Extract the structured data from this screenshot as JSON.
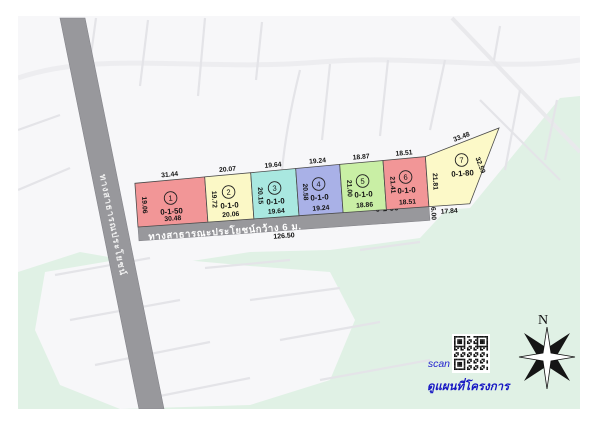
{
  "map": {
    "background_color": "#f7f7f9",
    "field_color": "#e0f1e5",
    "street_color": "#e4e4e8",
    "road_color": "#98989c",
    "plot_border_color": "#4a4a4a",
    "compass_label": "N",
    "vertical_road": {
      "label": "ทางสาธารณประโยชน์"
    },
    "main_road": {
      "label": "ทางสาธารณะประโยชน์กว้าง 6 ม.",
      "area": "0-1-90",
      "length": "126.50",
      "width_at_end": "6.00"
    },
    "qr": {
      "scan_label": "scan",
      "caption": "ดูแผนที่โครงการ"
    }
  },
  "plots": [
    {
      "no": "1",
      "area": "0-1-50",
      "color": "#f29697",
      "top": "31.44",
      "bottom": "30.48",
      "left": "19.06"
    },
    {
      "no": "2",
      "area": "0-1-0",
      "color": "#fbf8c6",
      "top": "20.07",
      "bottom": "20.06",
      "left": "19.72"
    },
    {
      "no": "3",
      "area": "0-1-0",
      "color": "#a9e8e0",
      "top": "19.64",
      "bottom": "19.64",
      "left": "20.15"
    },
    {
      "no": "4",
      "area": "0-1-0",
      "color": "#a9b1e7",
      "top": "19.24",
      "bottom": "19.24",
      "left": "20.58"
    },
    {
      "no": "5",
      "area": "0-1-0",
      "color": "#c9efa5",
      "top": "18.87",
      "bottom": "18.86",
      "left": "21.00"
    },
    {
      "no": "6",
      "area": "0-1-0",
      "color": "#f29697",
      "top": "18.51",
      "bottom": "18.51",
      "left": "21.41"
    },
    {
      "no": "7",
      "area": "0-1-80",
      "color": "#fcf9c8",
      "top": "33.48",
      "bottom": "17.84",
      "left": "21.81",
      "right": "32.59"
    }
  ]
}
